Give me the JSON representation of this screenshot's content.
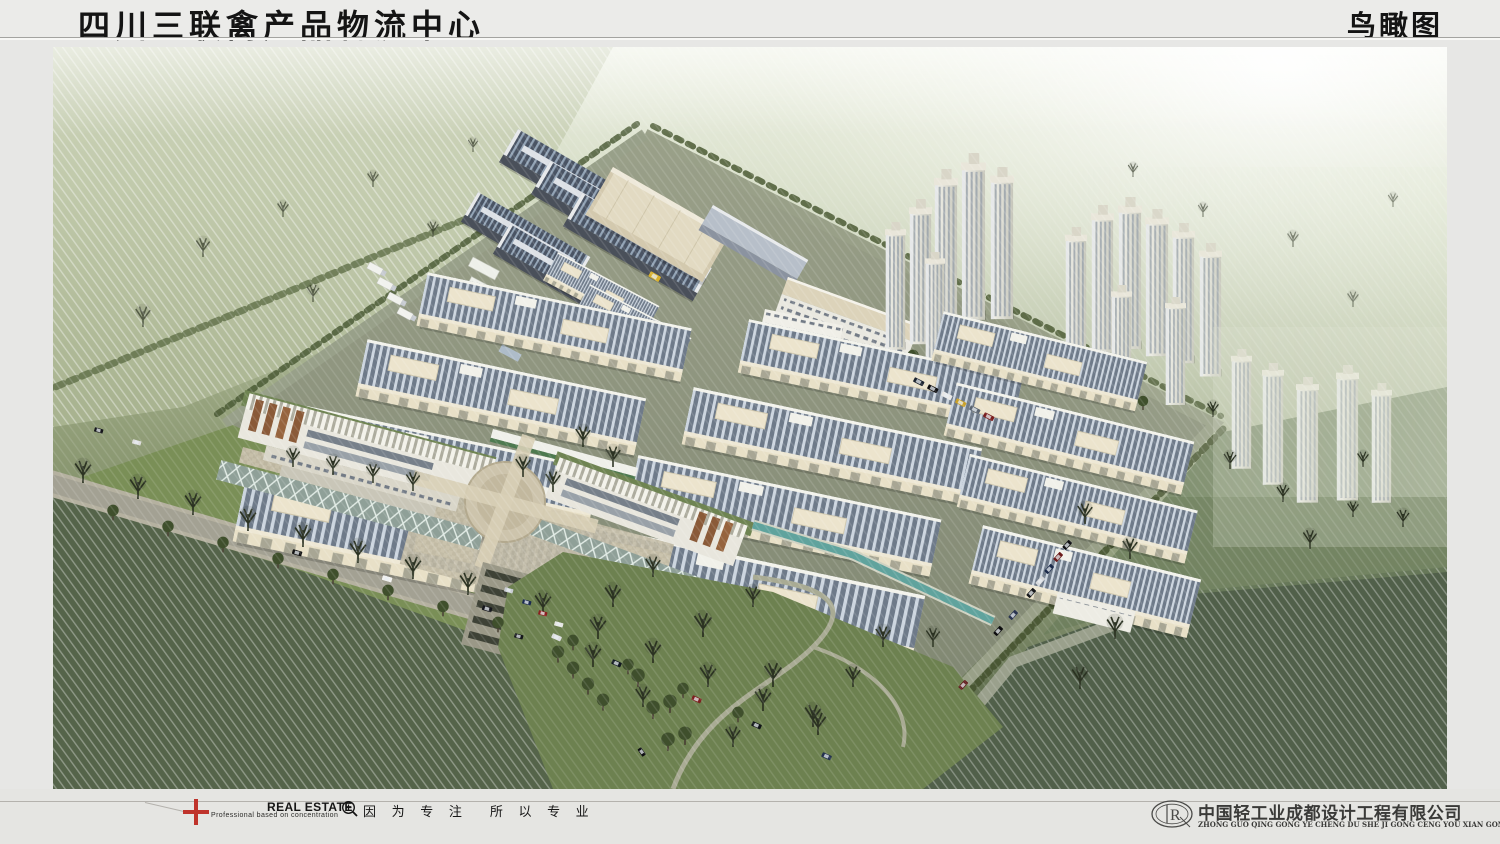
{
  "header": {
    "title": "四川三联禽产品物流中心",
    "view_label": "鸟瞰图"
  },
  "footer": {
    "tagline": "Professional  based on  concentration",
    "brand": "REAL ESTATE",
    "slogan_left": "因 为 专 注",
    "slogan_right": "所 以 专 业",
    "company": "中国轻工业成都设计工程有限公司",
    "company_pinyin": "ZHONG GUO QING GONG YE CHENG DU SHE JI GONG CENG YOU XIAN GONG SI",
    "logo_monogram": "R"
  },
  "icons": {
    "cross_logo": "red-cross-logo",
    "magnifier": "magnifier-zoom-icon",
    "company_logo": "oval-monogram-logo"
  },
  "scene": {
    "label": "bird's-eye aerial rendering of logistics center"
  },
  "colors": {
    "page_bg": "#e7e7e5",
    "cross_red": "#bf332b",
    "field_green": "#55644a",
    "mist_green": "#9aa681",
    "roof_slate": "#6e7a89",
    "roof_stripe": "#ccd5df",
    "wall_cream": "#e8e0c7",
    "paving_gray": "#8e947e",
    "water_teal": "#60a39d",
    "lawn_green": "#7a8f57"
  }
}
